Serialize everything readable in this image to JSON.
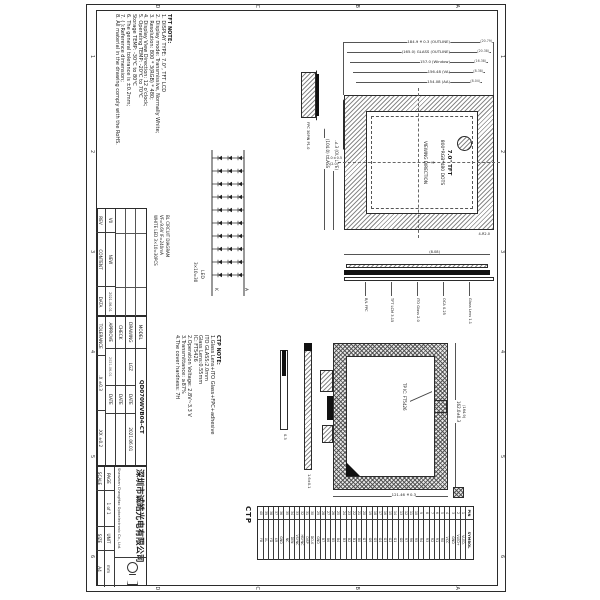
{
  "colors": {
    "line": "#2b2b2b",
    "hatch": "#8a8a8a",
    "text": "#1a1a1a",
    "black_fill": "#111111"
  },
  "sheet": {
    "zone_cols": [
      "1",
      "2",
      "3",
      "4",
      "5",
      "6"
    ],
    "zone_rows": [
      "A",
      "B",
      "C",
      "D"
    ]
  },
  "tft_note": {
    "title": "TFT NOTE:",
    "lines": [
      "1. DISPLAY TYPE: 7.0\", TFT LCD",
      "2. Display mode: Transmissive, Normally White;",
      "3. Resolution: 800 * 3(RGB) * 480;",
      "4. Display View Direction: 12 o'clock;",
      "5. Operating TEMP: -20℃ to 70℃",
      "    Storage TEMP: -30℃ to 80℃",
      "6. The general tolerance is ±0.2mm;",
      "7. ( ):Reference dimension;",
      "8. All material in the drawing comply with the RoHS."
    ]
  },
  "ctp_note": {
    "title": "CTP NOTE:",
    "lines": [
      "1.Glass Lens+ITO Glass+FPC+adhesive",
      "   ITO GLASS:2.0mm",
      "   Glass Lens:0.55mm",
      "   IC: FT5426",
      "2.Operation Voltage: 2.8V~3.3 V",
      "3.Transmittance: ≥87%",
      "4.The cover hardness: 7H"
    ]
  },
  "front_view": {
    "labels": [
      "7.0\" TFT",
      "800*RGB*480 DOTS",
      "VIEWING DIRECTION"
    ],
    "dims_vertical": [
      {
        "text": "184.9±0.3 (OUTLINE)",
        "end": "(20.79)"
      },
      {
        "text": "(165.0) GLASS (OUTLINE)",
        "end": "(20.38)"
      },
      {
        "text": "157.0 (Window)",
        "end": "(16.38)"
      },
      {
        "text": "156.48 (VA)",
        "end": "(8.38)"
      },
      {
        "text": "154.08 (AA)",
        "end": "(8.04)"
      }
    ],
    "dims_horizontal": [
      "112.8±0.3 (OUTLINE)",
      "(104.0) GLASS"
    ],
    "corner_label": "4-R2.0",
    "fpc_label": "FPC 30PIN P1.0",
    "fpc_dims": [
      "4.0±0.5",
      "(2.0)"
    ]
  },
  "side_section": {
    "layers": [
      "Glass Lens 1.1",
      "OCA 0.25",
      "ITO Glass 2.0",
      "TFT LCM 3.15",
      "B/L FPC"
    ],
    "overall": "(8.08)"
  },
  "back_view": {
    "dim_top": "162.0±0.3",
    "dim_top2": "(164.9)",
    "dim_right": "121.46±0.3",
    "ic_label": "TP IC: FT5426",
    "bar1_dim": "1.6±0.1",
    "bar2_dim": "0.3"
  },
  "bl_circuit": {
    "captions": [
      "BL CIRCUIT DIAGRAM",
      "VF=9.6V  IF=240mA",
      "WHITE LED 3×10=30PCS"
    ],
    "anode": "A",
    "cathode": "K",
    "led_label": "LED",
    "led_count": "3×10=30"
  },
  "pin_table": {
    "caption": "CTP",
    "headers": [
      "PIN",
      "SYMBOL"
    ],
    "names": [
      "VLED-",
      "VLED+",
      "GND",
      "VCC",
      "R0",
      "R1",
      "R2",
      "R3",
      "R4",
      "R5",
      "R6",
      "R7",
      "G0",
      "G1",
      "G2",
      "G3",
      "G4",
      "G5",
      "G6",
      "G7",
      "B0",
      "B1",
      "B2",
      "B3",
      "B4",
      "B5",
      "B6",
      "B7",
      "GND",
      "DCLK",
      "DISP",
      "HSYNC",
      "VSYNC",
      "DEN",
      "NC",
      "GND",
      "XR",
      "YD",
      "XL",
      "YU"
    ]
  },
  "revision_table": {
    "headers": [
      "REV",
      "CONTENT",
      "DATA"
    ],
    "entry": {
      "rev": "V0",
      "content": "NEW",
      "data": "2021-06-01"
    }
  },
  "title_block": {
    "model_label": "MODEL",
    "model": "QD070WVB04-CT",
    "drawing_label": "DRAWING",
    "drawing": "LGZ",
    "date_label": "DATE",
    "drawing_date": "2021.06.01",
    "check_label": "CHECK",
    "approve_label": "APPROVE",
    "approve_date": "2021-06-01",
    "tolerance_label": "TOLERANCE",
    "tolerance_x": ".X ±0.3",
    "tolerance_xx": ".XX ±0.2",
    "company_cn": "深圳市诚皓光电有限公司",
    "company_en": "Shenzhen ChengHao Optoelectronic Co., Ltd.",
    "page_label": "PAGE",
    "page": "1 of 1",
    "unit_label": "UNIT",
    "unit": "mm",
    "scale_label": "SCALE",
    "scale": "",
    "size_label": "SIZE",
    "size": "A4"
  }
}
